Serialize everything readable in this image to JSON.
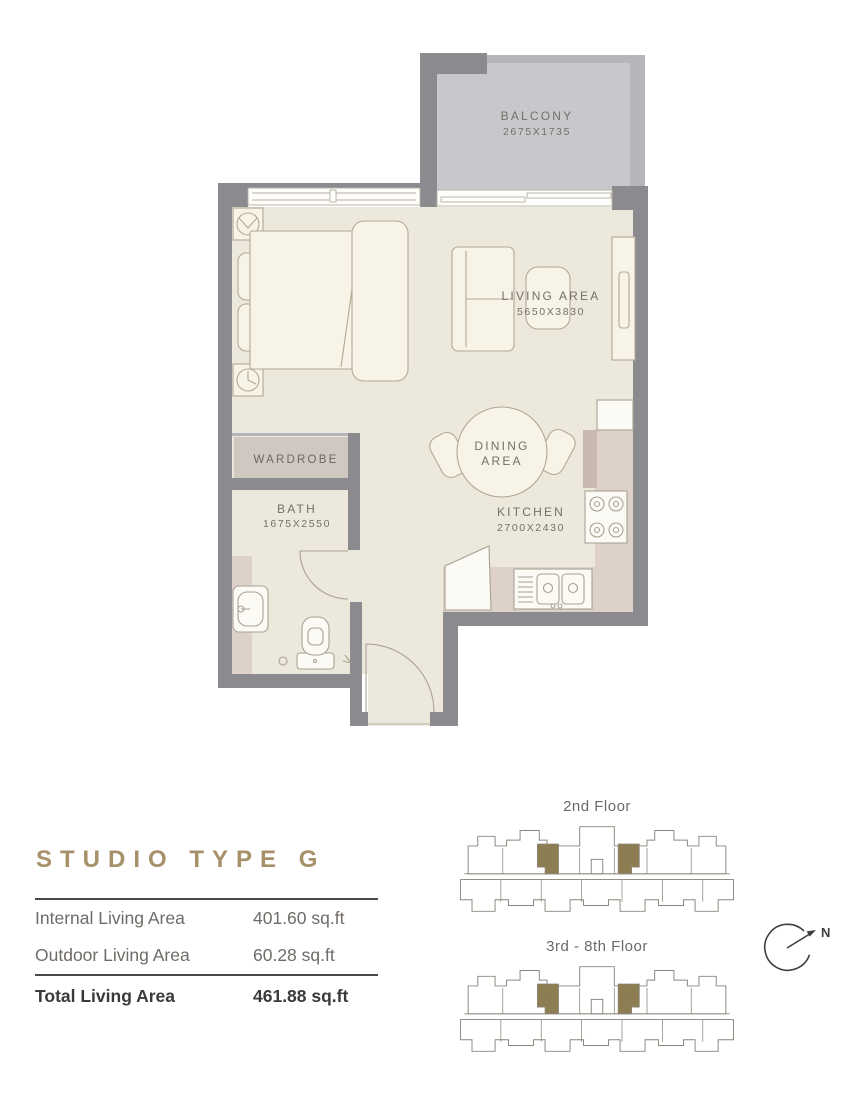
{
  "theme": {
    "wall": "#8b8b8f",
    "wallLight": "#b6b6ba",
    "balconyFloor": "#c8c7cb",
    "floor": "#ece8dc",
    "counter": "#ddd1ca",
    "counterStub": "#c9b8b1",
    "wardrobe": "#cfc8c1",
    "furnFill": "#f7f3e6",
    "furnLine": "#b3a894",
    "fixFill": "#fbfaf5",
    "fixLine": "#a9a294",
    "labelText": "#74706a",
    "gold": "#a6916b",
    "keyLine": "#8b867c",
    "keyFill": "#8d7d53",
    "textGray": "#6f6b67",
    "textDark": "#3b3a38",
    "lineDark": "#4b4a47",
    "compass": "#3f3f41"
  },
  "floor_plan": {
    "rooms": {
      "balcony": {
        "name": "BALCONY",
        "dims": "2675X1735"
      },
      "living": {
        "name": "LIVING AREA",
        "dims": "5650X3830"
      },
      "dining": {
        "line1": "DINING",
        "line2": "AREA"
      },
      "kitchen": {
        "name": "KITCHEN",
        "dims": "2700X2430"
      },
      "bath": {
        "name": "BATH",
        "dims": "1675X2550"
      },
      "wardrobe": {
        "name": "WARDROBE"
      }
    }
  },
  "unit_info": {
    "title": "STUDIO TYPE G",
    "rows": [
      {
        "label": "Internal Living Area",
        "value": "401.60 sq.ft"
      },
      {
        "label": "Outdoor Living Area",
        "value": "60.28 sq.ft"
      }
    ],
    "total": {
      "label": "Total Living Area",
      "value": "461.88 sq.ft"
    }
  },
  "key_plans": {
    "floors": [
      {
        "label": "2nd Floor"
      },
      {
        "label": "3rd - 8th Floor"
      }
    ]
  },
  "compass": {
    "label": "N"
  }
}
